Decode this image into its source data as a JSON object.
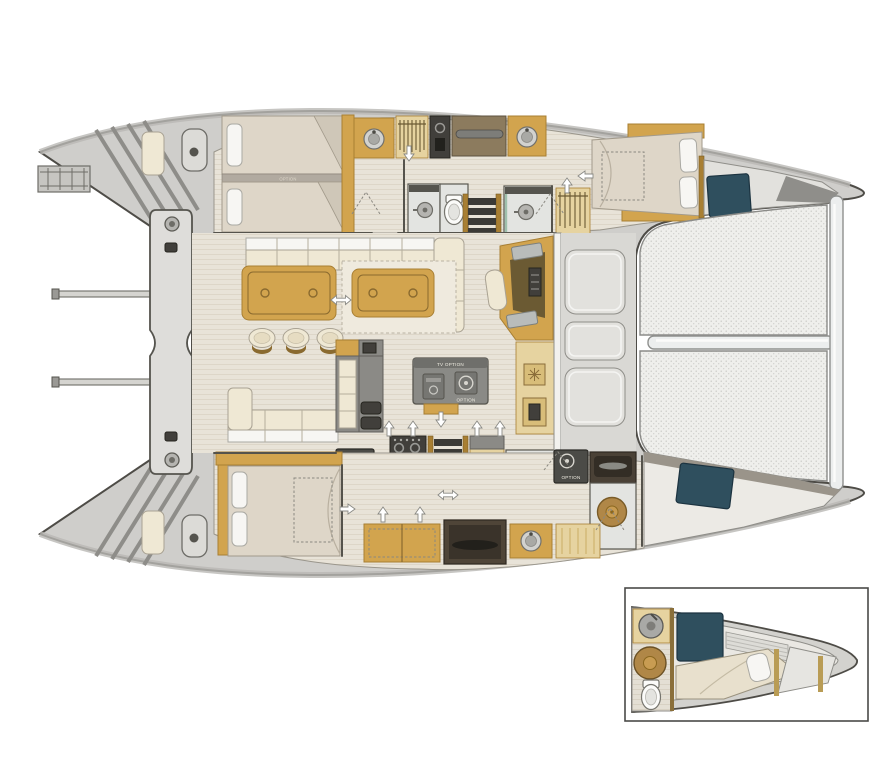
{
  "diagram": {
    "type": "boat-floorplan",
    "subject": "Catamaran deck and interior layout, plan view, bow to the right, with bow cabin detail inset",
    "labels": {
      "option": "OPTION",
      "tv_option": "TV OPTION"
    },
    "option_label_locations": [
      "port aft cabin berth divider",
      "galley island appliance",
      "galley washer unit",
      "starboard hull washer unit"
    ],
    "colors": {
      "hull_outline": "#4e4c47",
      "deck": "#cfcecb",
      "deck_band": "#b9b8b4",
      "floor": "#e8e3d8",
      "floor_line": "#ddd6c8",
      "wood": "#d2a44e",
      "wood_dark": "#a87f33",
      "wood_light": "#e6d3a0",
      "cream": "#efe8d4",
      "linen": "#ded6c8",
      "white": "#f7f6f3",
      "counter": "#8b8a86",
      "appliance": "#413f3b",
      "teal": "#2f4f5e",
      "steel": "#b9bcba",
      "tramp": "#efefec",
      "tramp_dot": "#c7c7c4",
      "grate": "#b08747",
      "shadow": "#8f8e8a"
    },
    "areas": {
      "aft": [
        "transom steps port and starboard",
        "swim ladder",
        "helm pods with winches",
        "davit arch with winches",
        "dinghy davit arms",
        "aft cockpit bench"
      ],
      "port_hull": [
        "aft cabin twin berths with option divider",
        "aft head with shower and toilet",
        "vanity sinks",
        "hanging lockers",
        "companionway stairs",
        "forward shower",
        "forward double berth",
        "bow locker with deck hatch"
      ],
      "salon": [
        "settee with cushions",
        "dining table with three stools",
        "coffee table on rug",
        "galley island with tv option and appliance option",
        "galley cabinets with twin sinks",
        "cooktop",
        "companionway stairs",
        "day head with toilet",
        "nav station with seat",
        "fridge cabinet"
      ],
      "foredeck": [
        "three seat pads",
        "forward crossbeam",
        "trampoline with center bar"
      ],
      "starboard_hull": [
        "aft cabin island double berth",
        "washer option units",
        "hanging rails",
        "day head toilet with sink",
        "shower with teak grate",
        "storage chest",
        "berth alcove",
        "vanity sink",
        "bow locker with deck hatch"
      ],
      "inset": [
        "bow detail: sink",
        "teak grate shower",
        "toilet",
        "single berth with pillow",
        "teal deck hatch"
      ]
    }
  }
}
